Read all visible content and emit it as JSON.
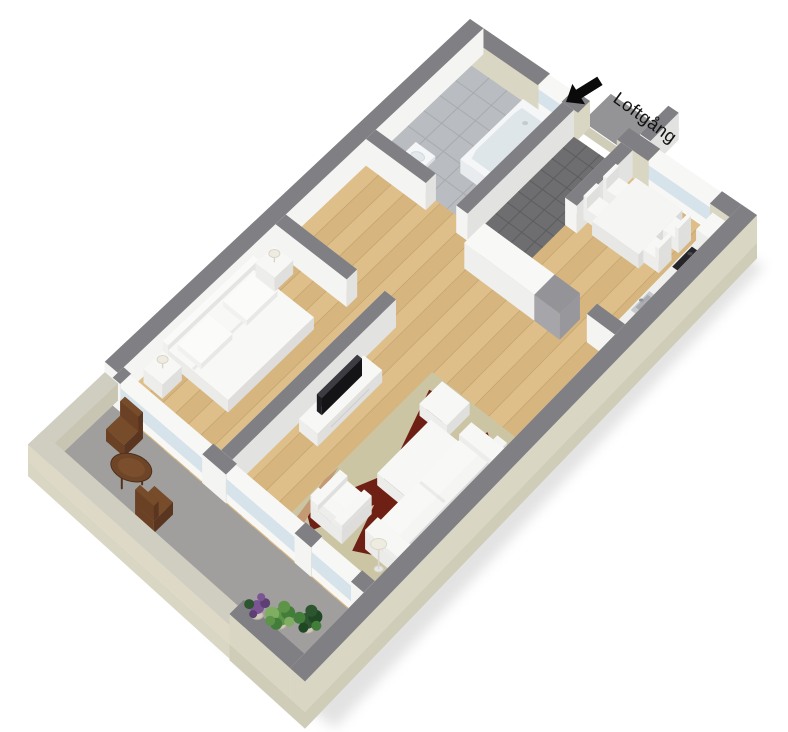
{
  "scene": {
    "type": "3d-floor-plan",
    "description": "Isometric 3D rendering of a one-bedroom apartment with balcony"
  },
  "annotation": {
    "walkway_label": "Loftgång",
    "arrow": "black arrow pointing down-left at the entrance door"
  },
  "rooms": [
    {
      "name": "Bathroom",
      "floor": "grey tile",
      "items": [
        "bathtub",
        "washbasin",
        "window"
      ]
    },
    {
      "name": "Entrance hall",
      "floor": "dark grey tile",
      "items": [
        "entrance-door-opening",
        "wardrobe-row",
        "grey-cabinet"
      ]
    },
    {
      "name": "Kitchen",
      "floor": "wood parquet",
      "items": [
        "dining-table",
        "four-chairs",
        "kitchen-counter",
        "cooktop",
        "kitchen-sink",
        "tall-cabinet",
        "window"
      ]
    },
    {
      "name": "Bedroom",
      "floor": "wood parquet",
      "items": [
        "double-bed",
        "two-nightstands",
        "two-table-lamps",
        "balcony-window"
      ]
    },
    {
      "name": "Living room",
      "floor": "wood parquet",
      "items": [
        "tv-stand",
        "flat-screen-tv",
        "rug",
        "coffee-table",
        "ottoman",
        "sofa",
        "armchair",
        "floor-lamp",
        "balcony-windows"
      ]
    },
    {
      "name": "Balcony",
      "floor": "concrete",
      "items": [
        "round-table",
        "two-folding-chairs",
        "three-potted-plants"
      ]
    }
  ],
  "colors": {
    "background": "#ffffff",
    "wall_top": "#7f7f84",
    "wall_face": "#f4f4f2",
    "wall_shade": "#e2e2e0",
    "ext_face": "#d9d6c3",
    "ext_skirt": "#cfccb8",
    "parapet_top": "#cfcec0",
    "parapet_face": "#ddd9c6",
    "parapet_shade": "#c8c5b2",
    "wood": "#debc83",
    "wood_seam": "rgba(120,80,35,0.22)",
    "bath_tile": "#b9bdc1",
    "bath_grout": "#a7abaf",
    "hall_tile": "#6e6e71",
    "hall_grout": "#5d5d60",
    "balcony_floor": "#a09f9d",
    "walkway": "#949496",
    "glass": "#d6e3ea",
    "win_frame": "#f7f7f5",
    "furniture_white": "#f6f6f4",
    "tv_black": "#1e1e22",
    "rug": "#cbc5a3",
    "rug_red": "#6f2015",
    "rug_tan": "#c49a75",
    "outdoor_brown": "#6f4527",
    "outdoor_brown_dark": "#53311b",
    "gray_unit": "#949498",
    "lamp_shade": "#eeebe1",
    "plant_dark": "#2c5530",
    "plant_mid": "#437d3a",
    "plant_light": "#5d9447",
    "plant_purple": "#7b5494",
    "shadow": "#c0c0c0"
  }
}
